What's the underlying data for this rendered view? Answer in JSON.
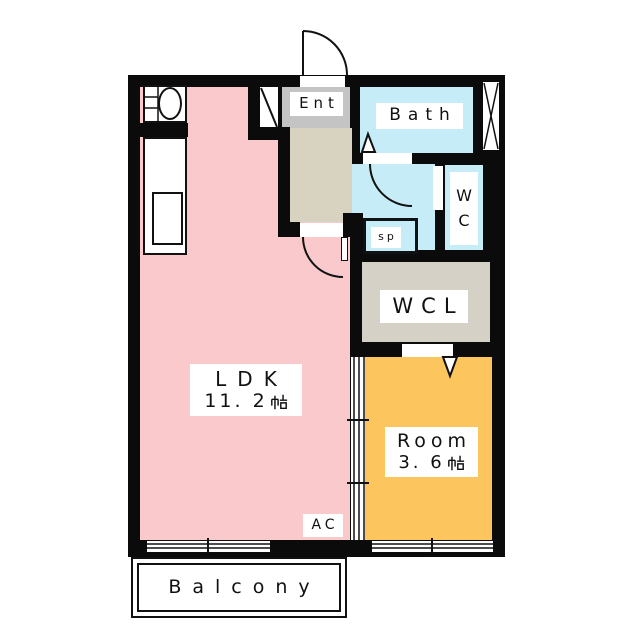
{
  "floorplan": {
    "rooms": {
      "ldk": {
        "label": "LDK",
        "area": "11.2帖",
        "area_number": "11. 2",
        "area_unit": "帖"
      },
      "bedroom": {
        "label": "Room",
        "area": "3.6帖",
        "area_number": "3. 6",
        "area_unit": "帖"
      },
      "bath": {
        "label": "Bath"
      },
      "wc": {
        "label": "WC",
        "letters": [
          "W",
          "C"
        ]
      },
      "wcl": {
        "label": "WCL"
      },
      "entrance": {
        "label": "Ent"
      },
      "washer_space": {
        "label": "sp"
      },
      "balcony": {
        "label": "Balcony"
      },
      "ac_unit": {
        "label": "AC"
      }
    },
    "colors": {
      "ldk": "#f9c9cb",
      "bedroom": "#fcc55e",
      "wet_area": "#c6ecf8",
      "entrance": "#c4c4c4",
      "hall": "#d8d2c0",
      "wcl": "#d5d1c6",
      "wall": "#0b0b0b",
      "background": "#ffffff"
    },
    "symbols": {
      "entrance_door": "swing-door-arc",
      "interior_doors": "swing-door-arc",
      "room_divider": "three-track-sliding-door",
      "windows": "double-line-sliding-window",
      "pipe_shaft": "x-hatch",
      "shoe_closet": "diagonal-slash",
      "kitchen": "sink-and-counter"
    }
  }
}
